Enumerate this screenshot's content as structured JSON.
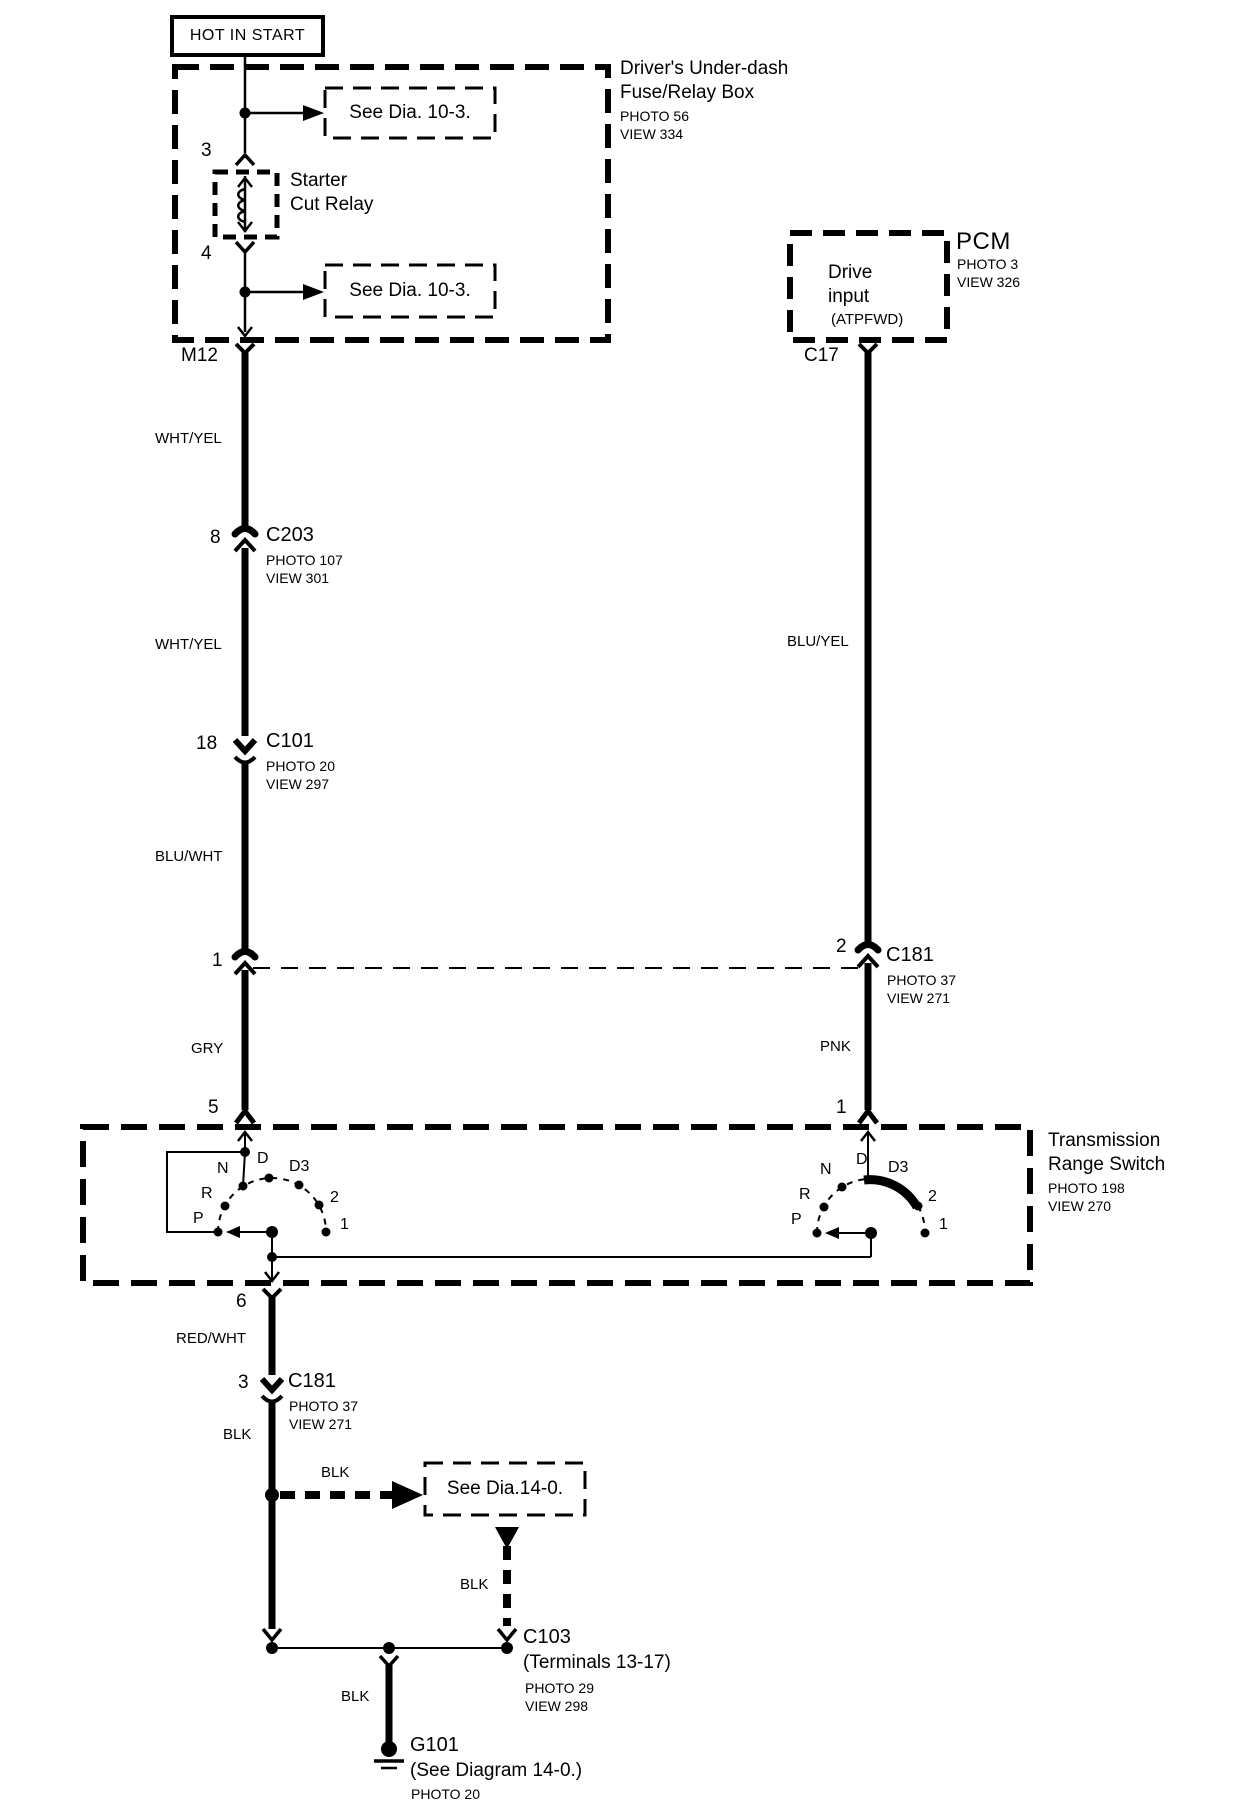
{
  "colors": {
    "ink": "#000000",
    "background": "#ffffff"
  },
  "hot_in_start": "HOT IN START",
  "fuse_box": {
    "title_line1": "Driver's Under-dash",
    "title_line2": "Fuse/Relay Box",
    "photo": "PHOTO 56",
    "view": "VIEW 334",
    "pin_top": "3",
    "pin_bottom": "4",
    "pin_out": "M12",
    "relay_line1": "Starter",
    "relay_line2": "Cut Relay",
    "see_top": "See Dia. 10-3.",
    "see_bottom": "See Dia. 10-3."
  },
  "pcm": {
    "name": "PCM",
    "photo": "PHOTO 3",
    "view": "VIEW 326",
    "input_line1": "Drive",
    "input_line2": "input",
    "input_line3": "(ATPFWD)",
    "pin_out": "C17"
  },
  "wires": {
    "wht_yel": "WHT/YEL",
    "blu_wht": "BLU/WHT",
    "gry": "GRY",
    "blu_yel": "BLU/YEL",
    "pnk": "PNK",
    "red_wht": "RED/WHT",
    "blk": "BLK"
  },
  "connectors": {
    "c203": {
      "pin": "8",
      "name": "C203",
      "photo": "PHOTO 107",
      "view": "VIEW 301"
    },
    "c101": {
      "pin": "18",
      "name": "C101",
      "photo": "PHOTO 20",
      "view": "VIEW 297"
    },
    "c181_left_pin": "1",
    "c181_right": {
      "pin": "2",
      "name": "C181",
      "photo": "PHOTO 37",
      "view": "VIEW 271"
    },
    "c181_bottom": {
      "pin": "3",
      "name": "C181",
      "photo": "PHOTO 37",
      "view": "VIEW 271"
    },
    "c103": {
      "name": "C103",
      "terminals": "(Terminals 13-17)",
      "photo": "PHOTO 29",
      "view": "VIEW 298"
    }
  },
  "trs": {
    "title_line1": "Transmission",
    "title_line2": "Range Switch",
    "photo": "PHOTO 198",
    "view": "VIEW 270",
    "pin_in_left": "5",
    "pin_in_right": "1",
    "pin_out": "6",
    "positions": [
      "P",
      "R",
      "N",
      "D",
      "D3",
      "2",
      "1"
    ]
  },
  "see_dia_14": "See Dia.14-0.",
  "ground": {
    "name": "G101",
    "note": "(See Diagram 14-0.)",
    "photo": "PHOTO 20"
  }
}
